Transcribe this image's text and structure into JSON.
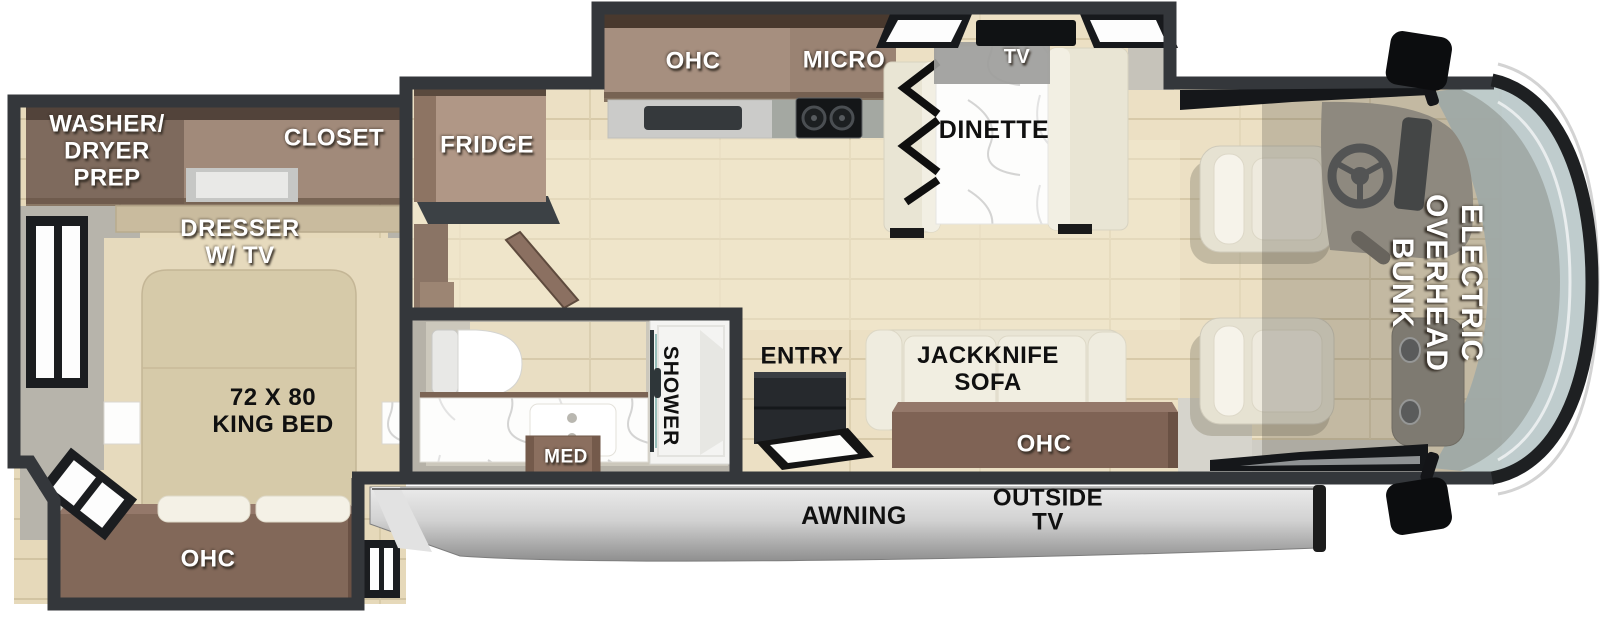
{
  "floorplan": {
    "labels": {
      "washer_dryer_prep": "WASHER/\nDRYER\nPREP",
      "closet": "CLOSET",
      "dresser_tv": "DRESSER\nW/ TV",
      "king_bed": "72 X 80\nKING BED",
      "ohc_bedroom": "OHC",
      "fridge": "FRIDGE",
      "ohc_kitchen": "OHC",
      "micro": "MICRO",
      "tv": "TV",
      "dinette": "DINETTE",
      "entry": "ENTRY",
      "jackknife_sofa": "JACKKNIFE\nSOFA",
      "ohc_sofa": "OHC",
      "shower": "SHOWER",
      "med": "MED",
      "awning": "AWNING",
      "outside_tv": "OUTSIDE\nTV",
      "electric_overhead_bunk": "ELECTRIC\nOVERHEAD\nBUNK"
    },
    "colors": {
      "wall": "#34373b",
      "floor_wood": "#ece0c4",
      "bedroom_floor": "#e6d9ba",
      "cabinet_brown": "#8f7565",
      "cabinet_dark_trim": "#49392e",
      "fridge": "#b09786",
      "upholstery_cream": "#e9e5d5",
      "bed_tan": "#d6caa9",
      "marble": "#fdfdfc",
      "counter_gray": "#cbcbc9",
      "glass_blue": "#bcc9ca",
      "awning_silver": "#cfcfcf",
      "overlay_shade": "rgba(84,80,70,0.27)",
      "label_white": "#ffffff",
      "label_black": "#101010"
    }
  }
}
